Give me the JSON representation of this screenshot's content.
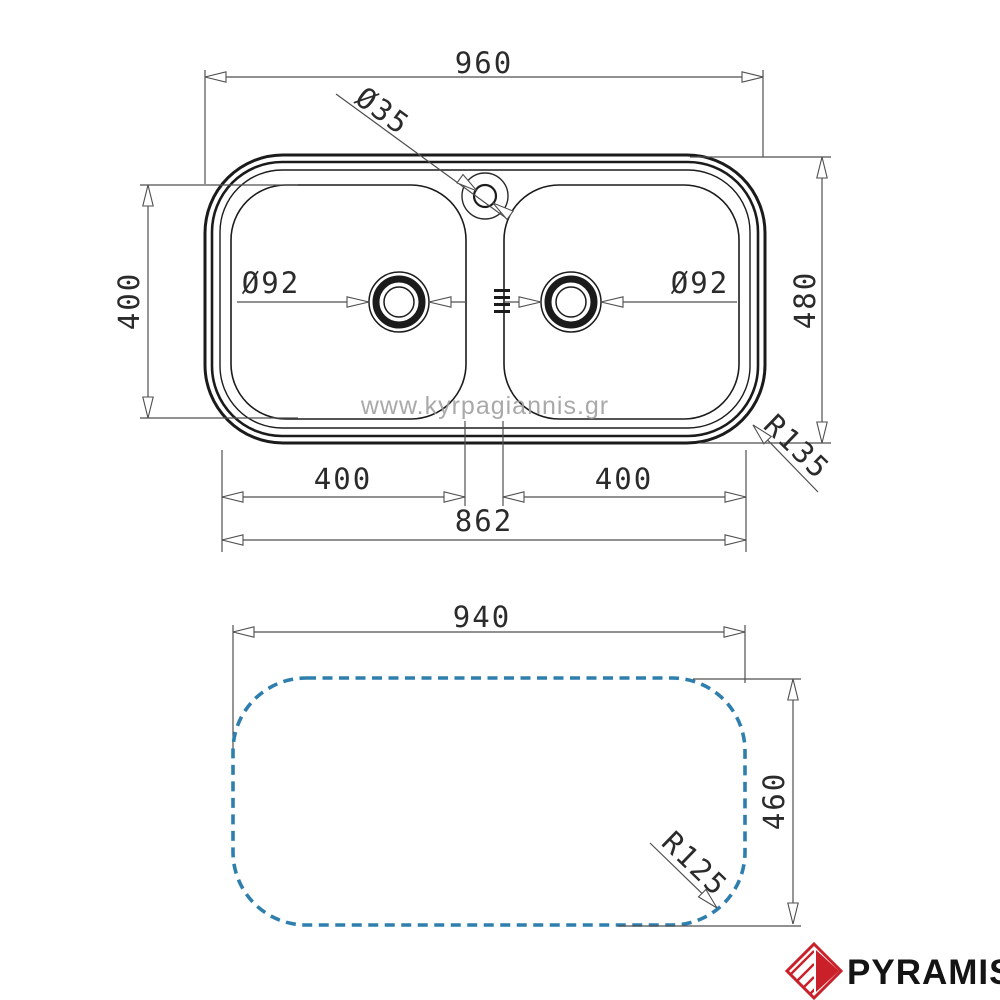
{
  "watermark": "www.kyrpagiannis.gr",
  "brand": {
    "name": "PYRAMIS"
  },
  "colors": {
    "outline": "#1b1b1b",
    "dimension": "#4f4f4f",
    "cutout": "#2e7fae",
    "watermark": "#9b9b9b",
    "brand_red": "#c9202a",
    "brand_text": "#141414"
  },
  "top_view": {
    "overall_width": "960",
    "overall_depth": "480",
    "bowl_depth": "400",
    "bowl_width_left": "400",
    "bowl_width_right": "400",
    "inner_width": "862",
    "faucet_hole": "Ø35",
    "drain_left": "Ø92",
    "drain_right": "Ø92",
    "corner_radius": "R135"
  },
  "cutout_view": {
    "width": "940",
    "height": "460",
    "corner_radius": "R125"
  }
}
